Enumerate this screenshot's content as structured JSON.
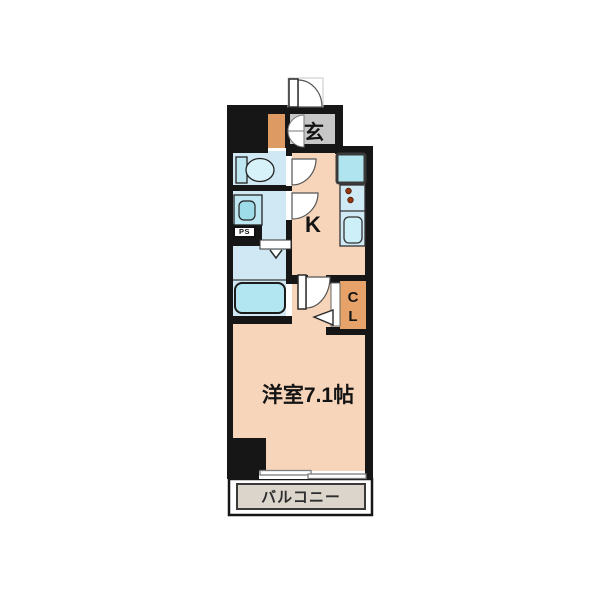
{
  "plan": {
    "title": "apartment-floor-plan",
    "labels": {
      "entrance": "玄",
      "kitchen": "K",
      "closet": "C\nL",
      "pipe_space": "PS",
      "main_room": "洋室7.1帖",
      "balcony": "バルコニー"
    },
    "rooms": [
      {
        "name": "entrance-genkan",
        "label": "玄"
      },
      {
        "name": "kitchen",
        "label": "K"
      },
      {
        "name": "toilet",
        "label": ""
      },
      {
        "name": "washroom",
        "label": ""
      },
      {
        "name": "bathroom",
        "label": ""
      },
      {
        "name": "pipe-space",
        "label": "PS"
      },
      {
        "name": "closet",
        "label": "CL"
      },
      {
        "name": "western-room",
        "label": "洋室7.1帖"
      },
      {
        "name": "balcony",
        "label": "バルコニー"
      }
    ],
    "colors": {
      "wall": "#161616",
      "floor_main": "#f6d5ba",
      "floor_wet": "#cfe8f4",
      "floor_entrance": "#c7c7c7",
      "floor_balcony": "#dbd5cc",
      "closet_orange": "#e6a268",
      "shoe_cabinet_orange": "#dd9a62",
      "fixture_blue": "#bfe7f2",
      "fixture_light": "#d8f2fa",
      "bathtub_blue": "#b2e6f0",
      "counter_blue": "#cfe9f5",
      "refrigerator_blue": "#b0e4ee",
      "burner_dot": "#96380e"
    }
  }
}
